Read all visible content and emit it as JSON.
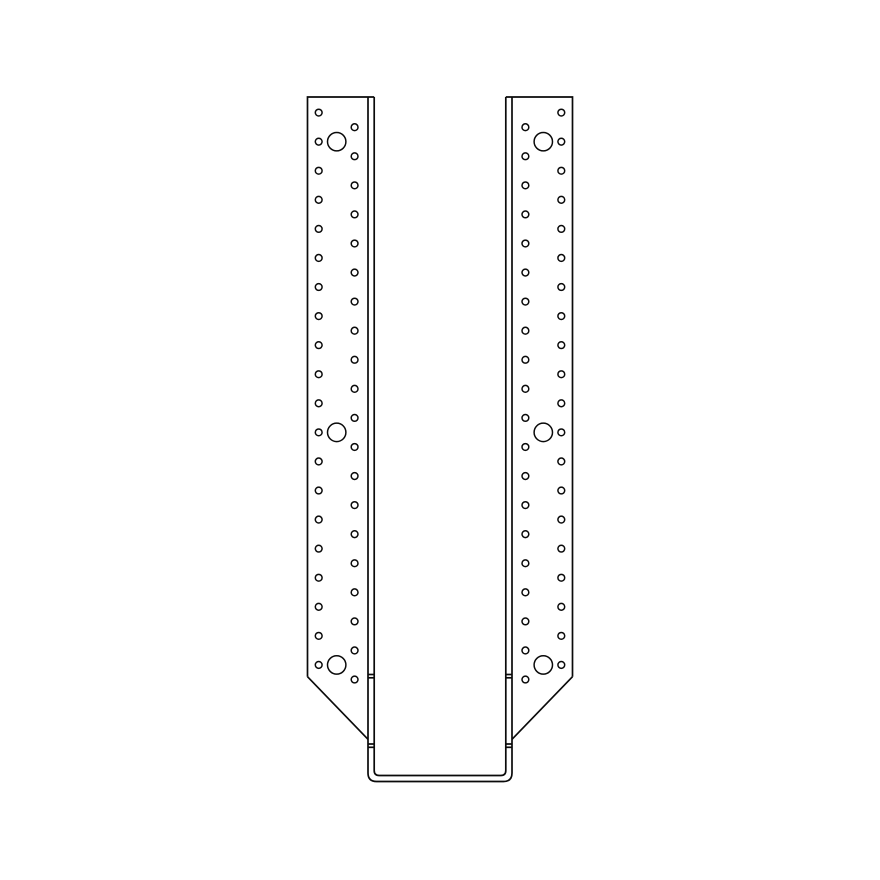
{
  "canvas": {
    "width": 880,
    "height": 880,
    "background": "#ffffff"
  },
  "drawing": {
    "kind": "joist-hanger-front-elevation-line-art",
    "line_color": "#0a0a0a",
    "outline_stroke_width": 1.7,
    "hole_stroke_width": 1.5,
    "mirror_axis_x": 440,
    "top_y": 97,
    "plate": {
      "outer_x": 307.5,
      "inner_x": 374.2,
      "fold_x": 368,
      "bevel_start_y": 676.7,
      "bevel_end_y": 739.3
    },
    "seat": {
      "outer_x": 368,
      "inner_x": 374.2,
      "outer_bottom_y": 781.5,
      "inner_bottom_y": 775.5,
      "outer_corner_radius": 8.5,
      "inner_corner_radius": 5,
      "tick_ys": [
        674.5,
        677.8,
        744,
        747.3
      ]
    },
    "holes": {
      "small_radius": 3.4,
      "large_radius": 9.2,
      "pitch": 29.07,
      "outer_column": {
        "x": 318.7,
        "y0": 112.6,
        "count": 20
      },
      "inner_column": {
        "x": 354.6,
        "y0": 127.2,
        "count": 20
      },
      "large_holes": {
        "x": 336.7,
        "rows_on_outer_column": [
          1,
          11,
          19
        ]
      }
    }
  }
}
